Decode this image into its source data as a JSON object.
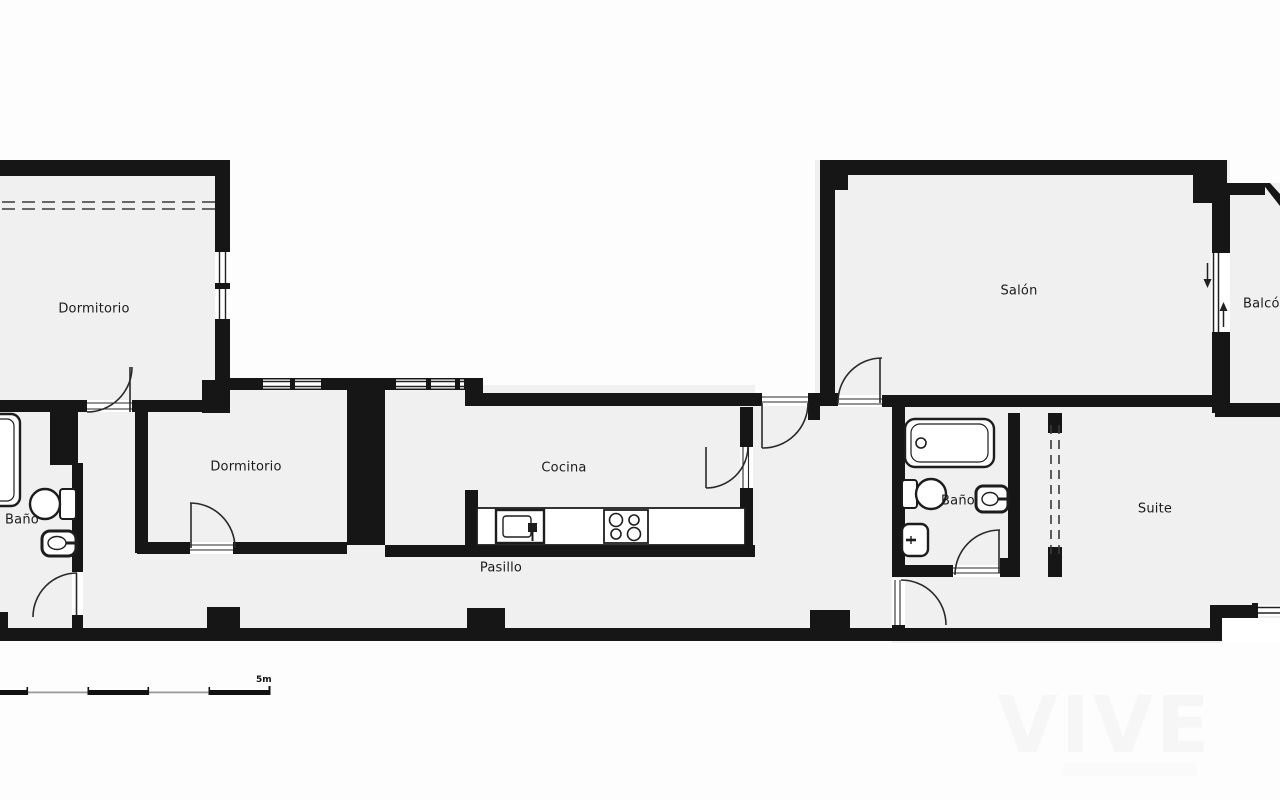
{
  "rooms": {
    "dormitorio1": "Dormitorio",
    "dormitorio2": "Dormitorio",
    "bano1": "Baño",
    "cocina": "Cocina",
    "pasillo": "Pasillo",
    "salon": "Salón",
    "balcon": "Balcón",
    "bano2": "Baño",
    "suite": "Suite"
  },
  "scale_bar": {
    "label": "5m"
  },
  "watermark": {
    "text": "VIVE"
  },
  "colors": {
    "wall": "#161616",
    "room_fill": "#f0f0f0",
    "background": "#ffffff",
    "door_stroke": "#2a2a2a"
  },
  "icons": [
    "bathtub-icon",
    "toilet-icon",
    "sink-icon",
    "bidet-icon",
    "kitchen-sink-icon",
    "stove-icon",
    "door-arc",
    "window",
    "sliding-door-arrows",
    "wardrobe-dashed-line",
    "scale-bar"
  ]
}
